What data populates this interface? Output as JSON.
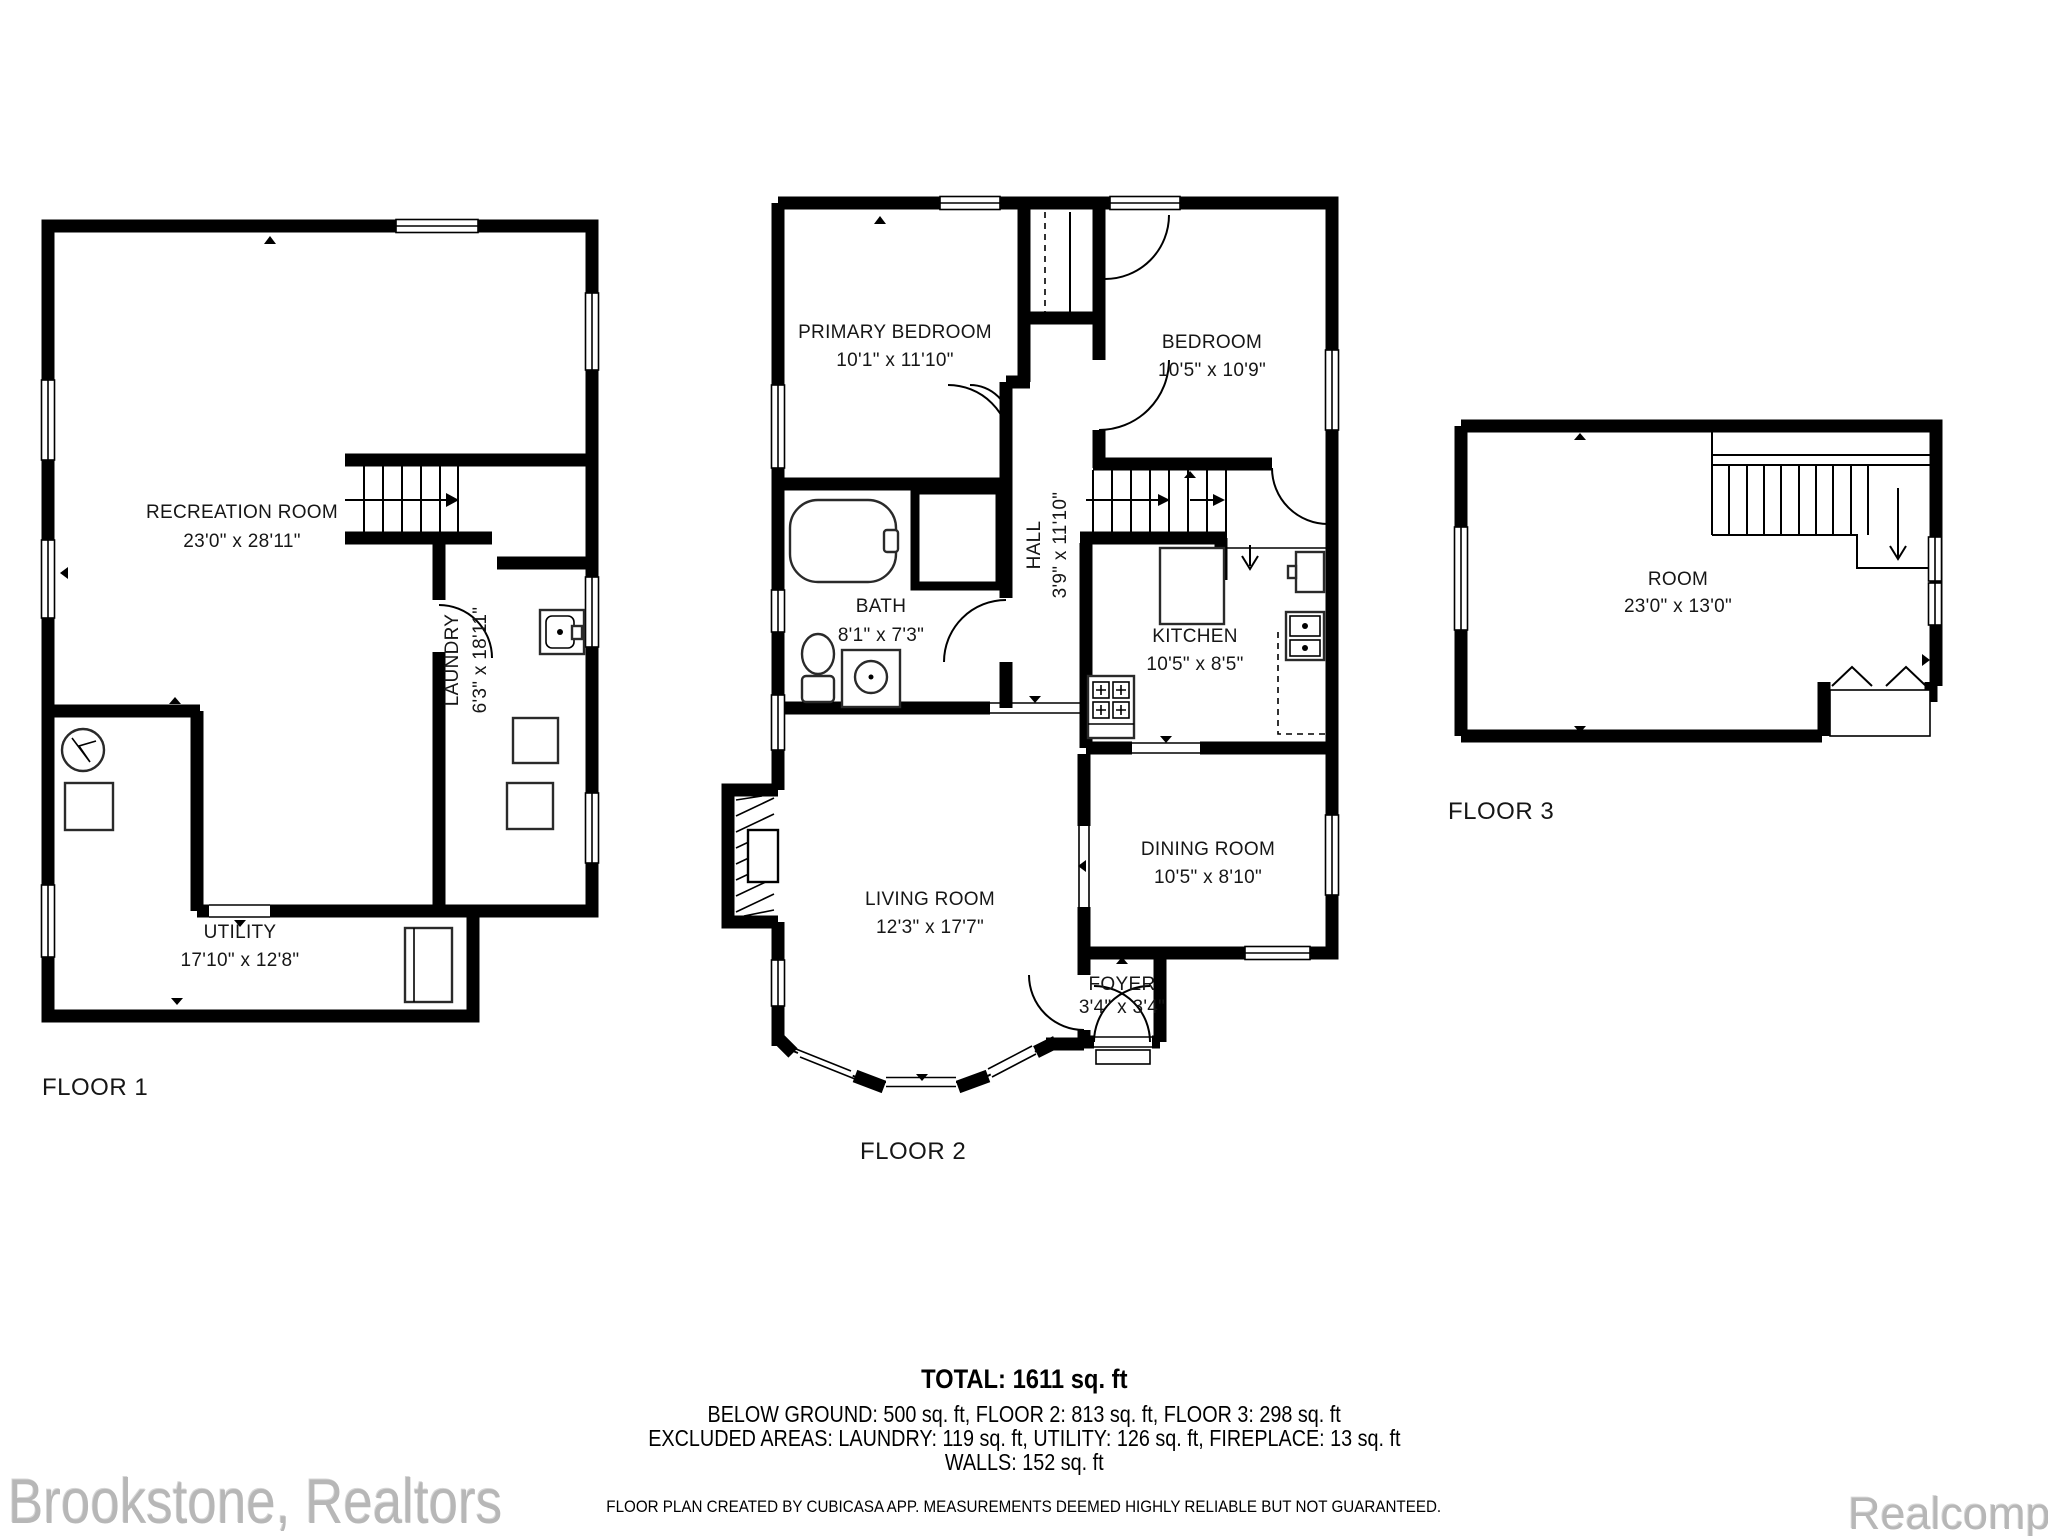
{
  "floors": {
    "floor1": {
      "label": "FLOOR 1",
      "rooms": {
        "recreation": {
          "name": "RECREATION ROOM",
          "dims": "23'0\" x 28'11\""
        },
        "utility": {
          "name": "UTILITY",
          "dims": "17'10\" x 12'8\""
        },
        "laundry": {
          "name": "LAUNDRY",
          "dims": "6'3\" x 18'11\""
        }
      }
    },
    "floor2": {
      "label": "FLOOR 2",
      "rooms": {
        "primary_bedroom": {
          "name": "PRIMARY BEDROOM",
          "dims": "10'1\" x 11'10\""
        },
        "bedroom": {
          "name": "BEDROOM",
          "dims": "10'5\" x 10'9\""
        },
        "hall": {
          "name": "HALL",
          "dims": "3'9\" x 11'10\""
        },
        "bath": {
          "name": "BATH",
          "dims": "8'1\" x 7'3\""
        },
        "kitchen": {
          "name": "KITCHEN",
          "dims": "10'5\" x 8'5\""
        },
        "living": {
          "name": "LIVING ROOM",
          "dims": "12'3\" x 17'7\""
        },
        "dining": {
          "name": "DINING ROOM",
          "dims": "10'5\" x 8'10\""
        },
        "foyer": {
          "name": "FOYER",
          "dims": "3'4\" x 3'4\""
        }
      }
    },
    "floor3": {
      "label": "FLOOR 3",
      "rooms": {
        "room": {
          "name": "ROOM",
          "dims": "23'0\" x 13'0\""
        }
      }
    }
  },
  "summary": {
    "total": "TOTAL: 1611 sq. ft",
    "floors_line": "BELOW GROUND: 500 sq. ft, FLOOR 2: 813 sq. ft, FLOOR 3: 298 sq. ft",
    "excluded_line": "EXCLUDED AREAS: LAUNDRY: 119 sq. ft, UTILITY: 126 sq. ft, FIREPLACE: 13 sq. ft",
    "walls_line": "WALLS: 152 sq. ft",
    "disclaimer": "FLOOR PLAN CREATED BY CUBICASA APP. MEASUREMENTS DEEMED HIGHLY RELIABLE BUT NOT GUARANTEED."
  },
  "watermarks": {
    "left": "Brookstone, Realtors",
    "right": "Realcomp"
  },
  "colors": {
    "wall": "#000000",
    "background": "#ffffff",
    "watermark": "#b7b7b7"
  }
}
